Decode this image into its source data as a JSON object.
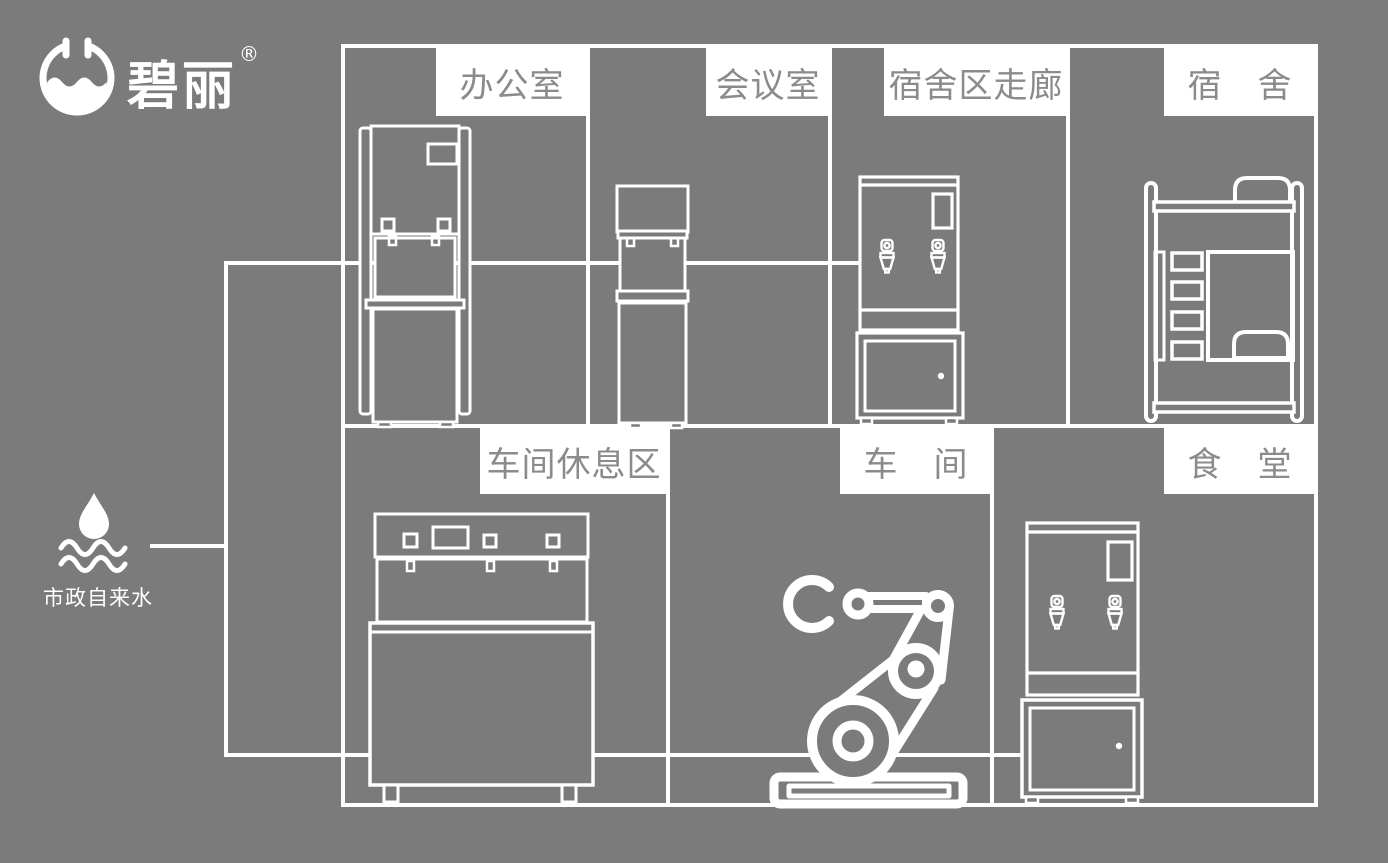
{
  "brand": {
    "name": "碧丽",
    "registered": "®"
  },
  "water_source": {
    "label": "市政自来水"
  },
  "rooms": {
    "office": {
      "label": "办公室"
    },
    "meeting_room": {
      "label": "会议室"
    },
    "dorm_corridor": {
      "label": "宿舍区走廊"
    },
    "dorm": {
      "label": "宿　舍"
    },
    "workshop_rest_area": {
      "label": "车间休息区"
    },
    "workshop": {
      "label": "车　间"
    },
    "canteen": {
      "label": "食　堂"
    }
  },
  "icons": {
    "brand_logo": "water-bowl-circle",
    "water_source": "water-drop-over-waves",
    "office_equipment": "floor-standing-water-dispenser",
    "meeting_room_equipment": "slim-water-dispenser",
    "corridor_equipment": "water-boiler-on-cabinet",
    "dorm_furniture": "bunk-bed",
    "rest_area_equipment": "wide-multi-tap-water-dispenser",
    "workshop_equipment": "industrial-robot-arm",
    "canteen_equipment": "water-boiler-on-cabinet"
  },
  "colors": {
    "background": "#7b7b7b",
    "line": "#ffffff",
    "label_bg": "#ffffff",
    "label_text": "#8b8b8b"
  }
}
